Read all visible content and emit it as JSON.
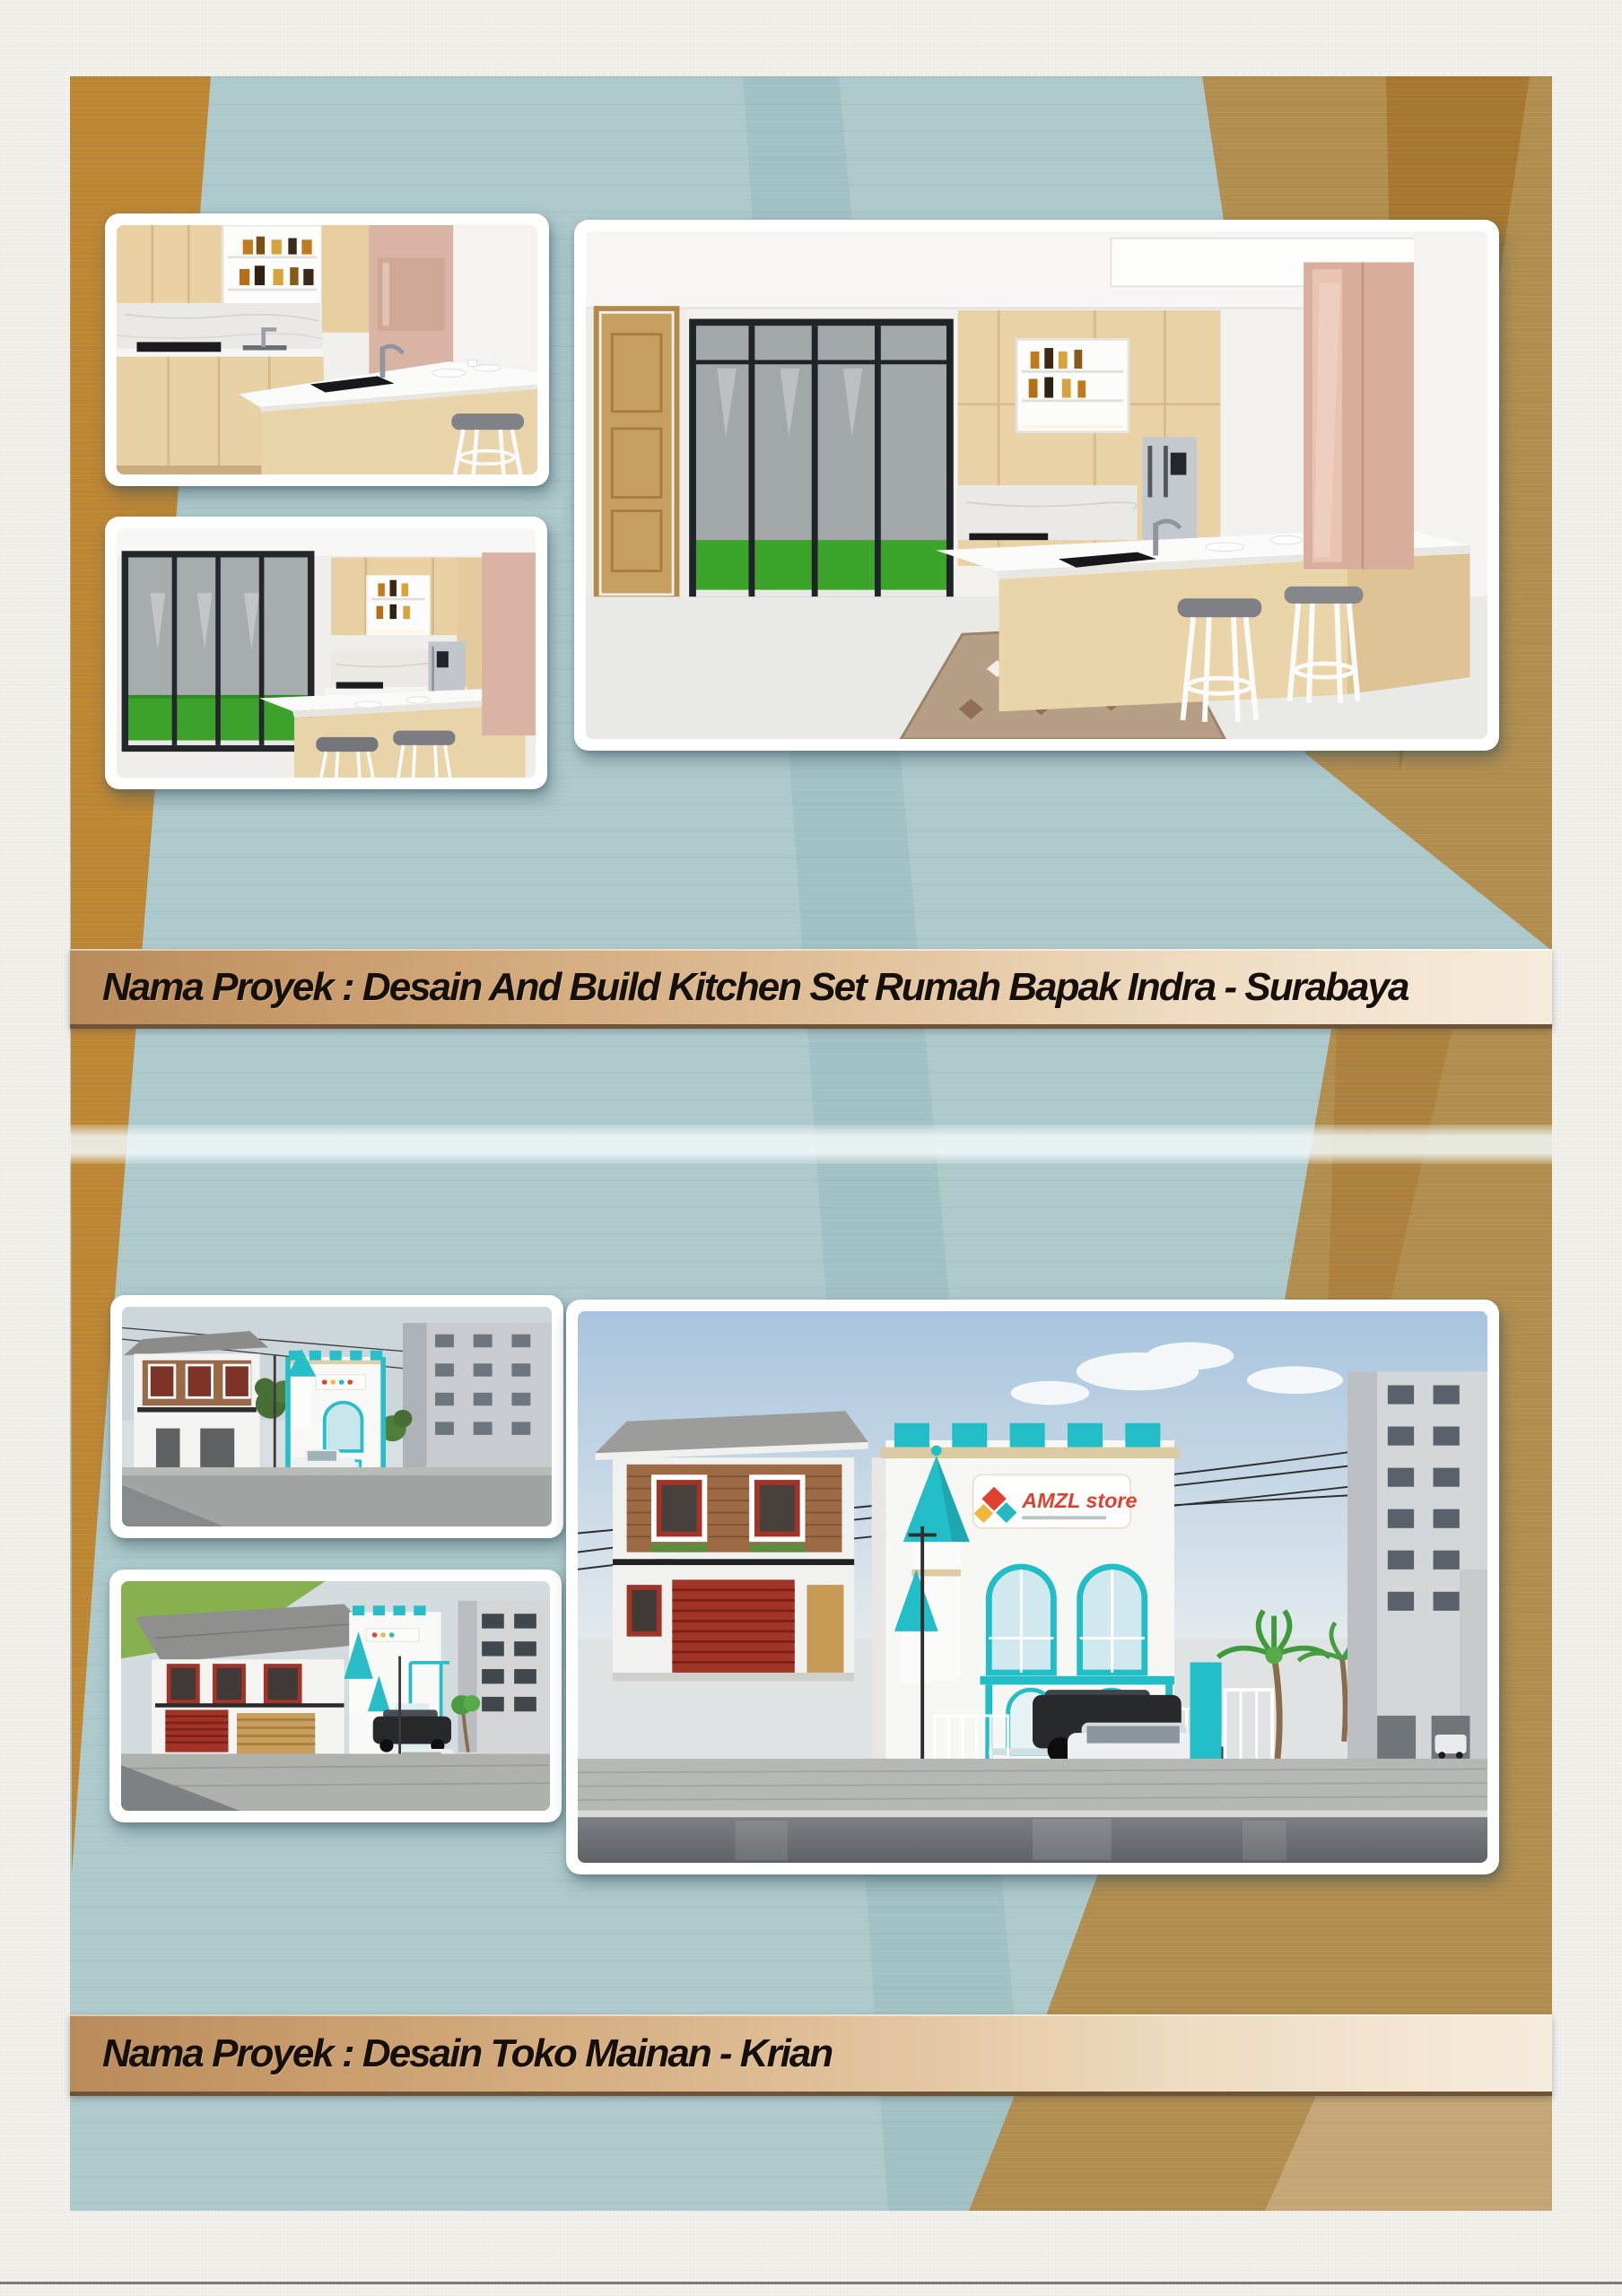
{
  "sections": [
    {
      "banner_label": "Nama Proyek : Desain And Build Kitchen Set Rumah Bapak Indra - Surabaya",
      "images": [
        {
          "alt": "Kitchen set close-up render"
        },
        {
          "alt": "Kitchen with glass sliding door render"
        },
        {
          "alt": "Kitchen set main render"
        }
      ]
    },
    {
      "banner_label": "Nama Proyek : Desain Toko Mainan - Krian",
      "images": [
        {
          "alt": "Toy store street view render"
        },
        {
          "alt": "Toy store perspective render"
        },
        {
          "alt": "Toy store front elevation render",
          "sign_text": "AMZL store"
        }
      ]
    }
  ],
  "colors": {
    "canvas_paper": "#f2f1ec",
    "background_blue": "#adc9cc",
    "side_band_brown": "#bd8633",
    "right_band_tan": "#b28e4e",
    "banner_left": "#b98b5c",
    "banner_right": "#f6ecdd",
    "banner_text": "#17100a",
    "store_teal": "#22bec7"
  }
}
